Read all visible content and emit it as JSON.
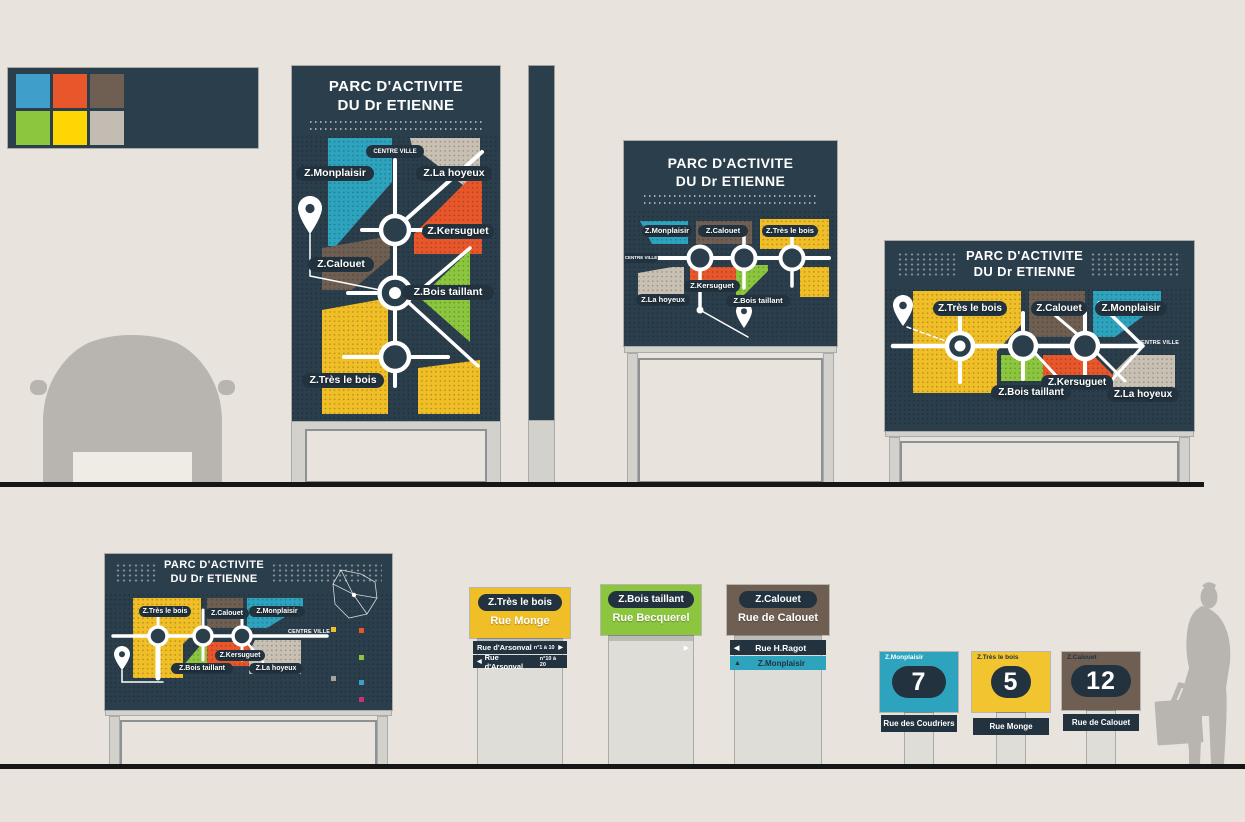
{
  "palette": {
    "swatches": [
      "#3F9FCA",
      "#E8562B",
      "#6F5F52",
      "#8CC63F",
      "#FFD504",
      "#C2BCB3"
    ]
  },
  "sign_title": {
    "line1": "PARC D'ACTIVITE",
    "line2": "DU Dr ETIENNE"
  },
  "map": {
    "centre_ville": "CENTRE VILLE",
    "zones": {
      "monplaisir": {
        "label": "Z.Monplaisir",
        "color": "#2EA3BE"
      },
      "la_hoyeux": {
        "label": "Z.La hoyeux",
        "color": "#C8C1B3"
      },
      "kersuguet": {
        "label": "Z.Kersuguet",
        "color": "#E8562B"
      },
      "calouet": {
        "label": "Z.Calouet",
        "color": "#6F5F52"
      },
      "bois_taillant": {
        "label": "Z.Bois taillant",
        "color": "#8CC63F"
      },
      "tres_le_bois": {
        "label": "Z.Très le bois",
        "color": "#F0BE27"
      }
    }
  },
  "street_signs": [
    {
      "zone": "Z.Très le bois",
      "street": "Rue Monge",
      "bars": [
        {
          "label": "Rue d'Arsonval",
          "range": "n°1 à 10",
          "arrow": "▶"
        },
        {
          "label": "Rue d'Arsonval",
          "range": "n°10 à 20",
          "arrow": "◀"
        }
      ]
    },
    {
      "zone": "Z.Bois taillant",
      "street": "Rue Becquerel"
    },
    {
      "zone": "Z.Calouet",
      "street": "Rue de Calouet",
      "bars": [
        {
          "label": "Rue H.Ragot",
          "arrow": "◀"
        },
        {
          "label": "Z.Monplaisir",
          "arrow": "▲"
        }
      ]
    }
  ],
  "number_signs": [
    {
      "zone": "Z.Monplaisir",
      "number": "7",
      "street": "Rue des Coudriers"
    },
    {
      "zone": "Z.Très le bois",
      "number": "5",
      "street": "Rue Monge"
    },
    {
      "zone": "Z.Calouet",
      "number": "12",
      "street": "Rue de Calouet"
    }
  ],
  "colors": {
    "panel": "#2B3E4C",
    "band": "#22333F",
    "background": "#E8E3DD",
    "ground": "#161616",
    "silhouette": "#B8B5B0",
    "post": "#DFDDD8",
    "accent_magenta": "#C9317E"
  }
}
